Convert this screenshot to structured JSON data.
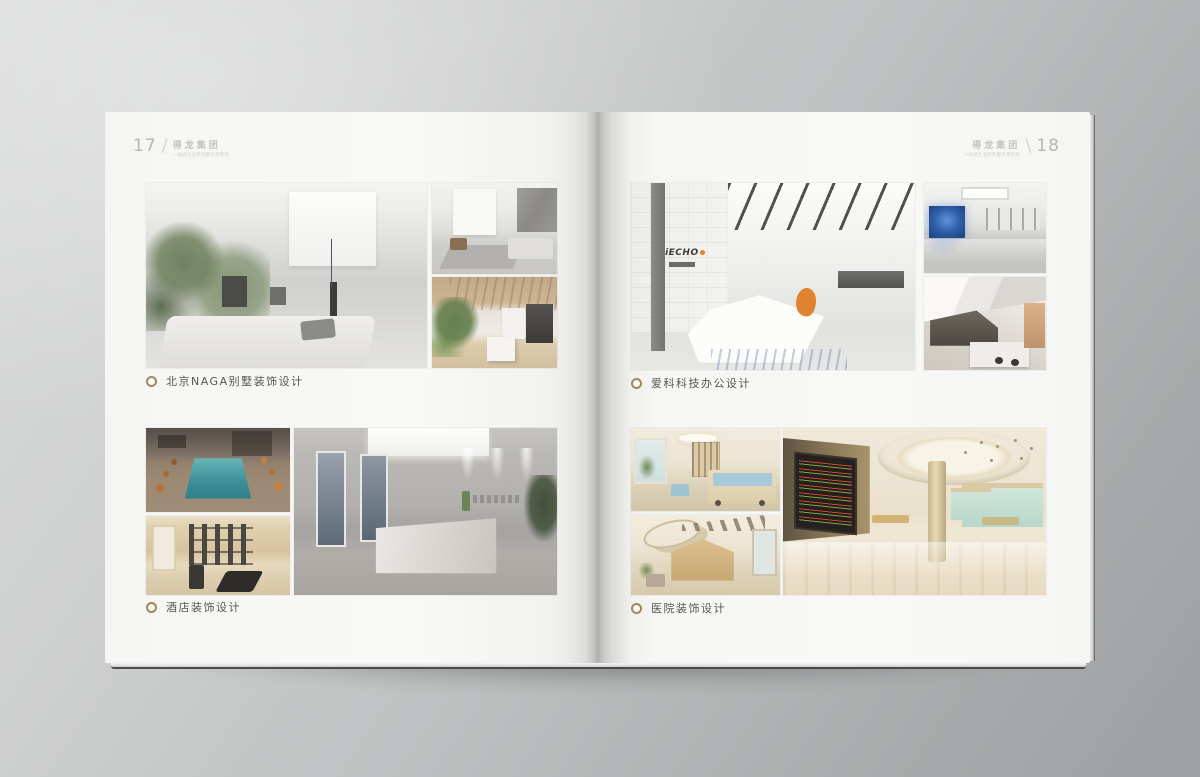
{
  "colors": {
    "accent_gold": "#a3845c",
    "accent_orange": "#e0832f",
    "caption_text": "#57554f",
    "header_text": "#c6c2ba",
    "page": "#f7f7f5",
    "backdrop_light": "#dadbdb",
    "backdrop_dark": "#9da0a1"
  },
  "brand": {
    "name": "得龙集团",
    "tagline": "一站式企业装饰服务定制商"
  },
  "left_page": {
    "page_number": "17",
    "slash": "/",
    "sections": [
      {
        "caption": "北京NAGA别墅装饰设计"
      },
      {
        "caption": "酒店装饰设计"
      }
    ]
  },
  "right_page": {
    "page_number": "18",
    "slash": "\\",
    "sections": [
      {
        "caption": "爱科科技办公设计",
        "logo_text": "iECHO"
      },
      {
        "caption": "医院装饰设计"
      }
    ]
  }
}
